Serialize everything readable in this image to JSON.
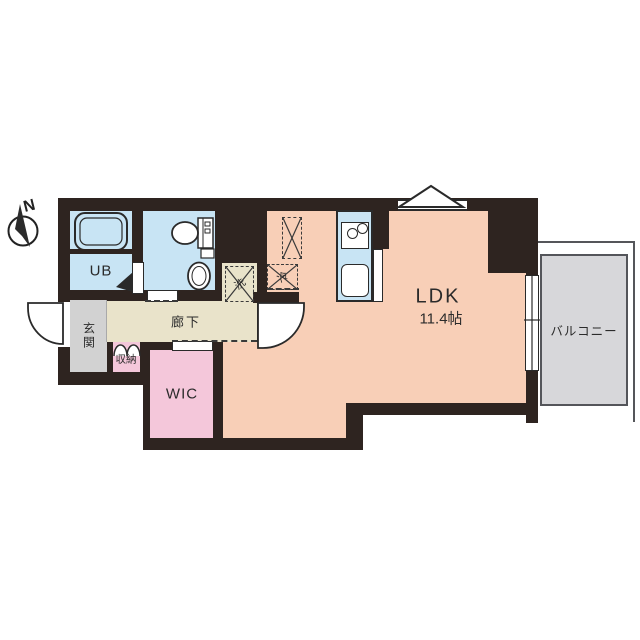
{
  "floor_plan": {
    "compass": {
      "north_label": "N"
    },
    "rooms": {
      "ldk": {
        "label": "LDK",
        "size": "11.4帖"
      },
      "unit_bath": {
        "label": "UB"
      },
      "entrance": {
        "label": "玄関"
      },
      "hallway": {
        "label": "廊下"
      },
      "storage": {
        "label": "収納"
      },
      "walk_in_closet": {
        "label": "WIC"
      },
      "balcony": {
        "label": "バルコニー"
      }
    },
    "appliance_spaces": {
      "washer": {
        "label": "洗"
      },
      "refrigerator": {
        "label": "冷"
      }
    },
    "colors": {
      "wall": "#2e2420",
      "ldk_fill": "#f8cfb7",
      "wet_area_fill": "#c8e4f4",
      "closet_fill": "#f4c7da",
      "hallway_fill": "#e9e3ca",
      "entrance_fill": "#d2d2d2",
      "balcony_fill": "#d7d7da"
    }
  }
}
